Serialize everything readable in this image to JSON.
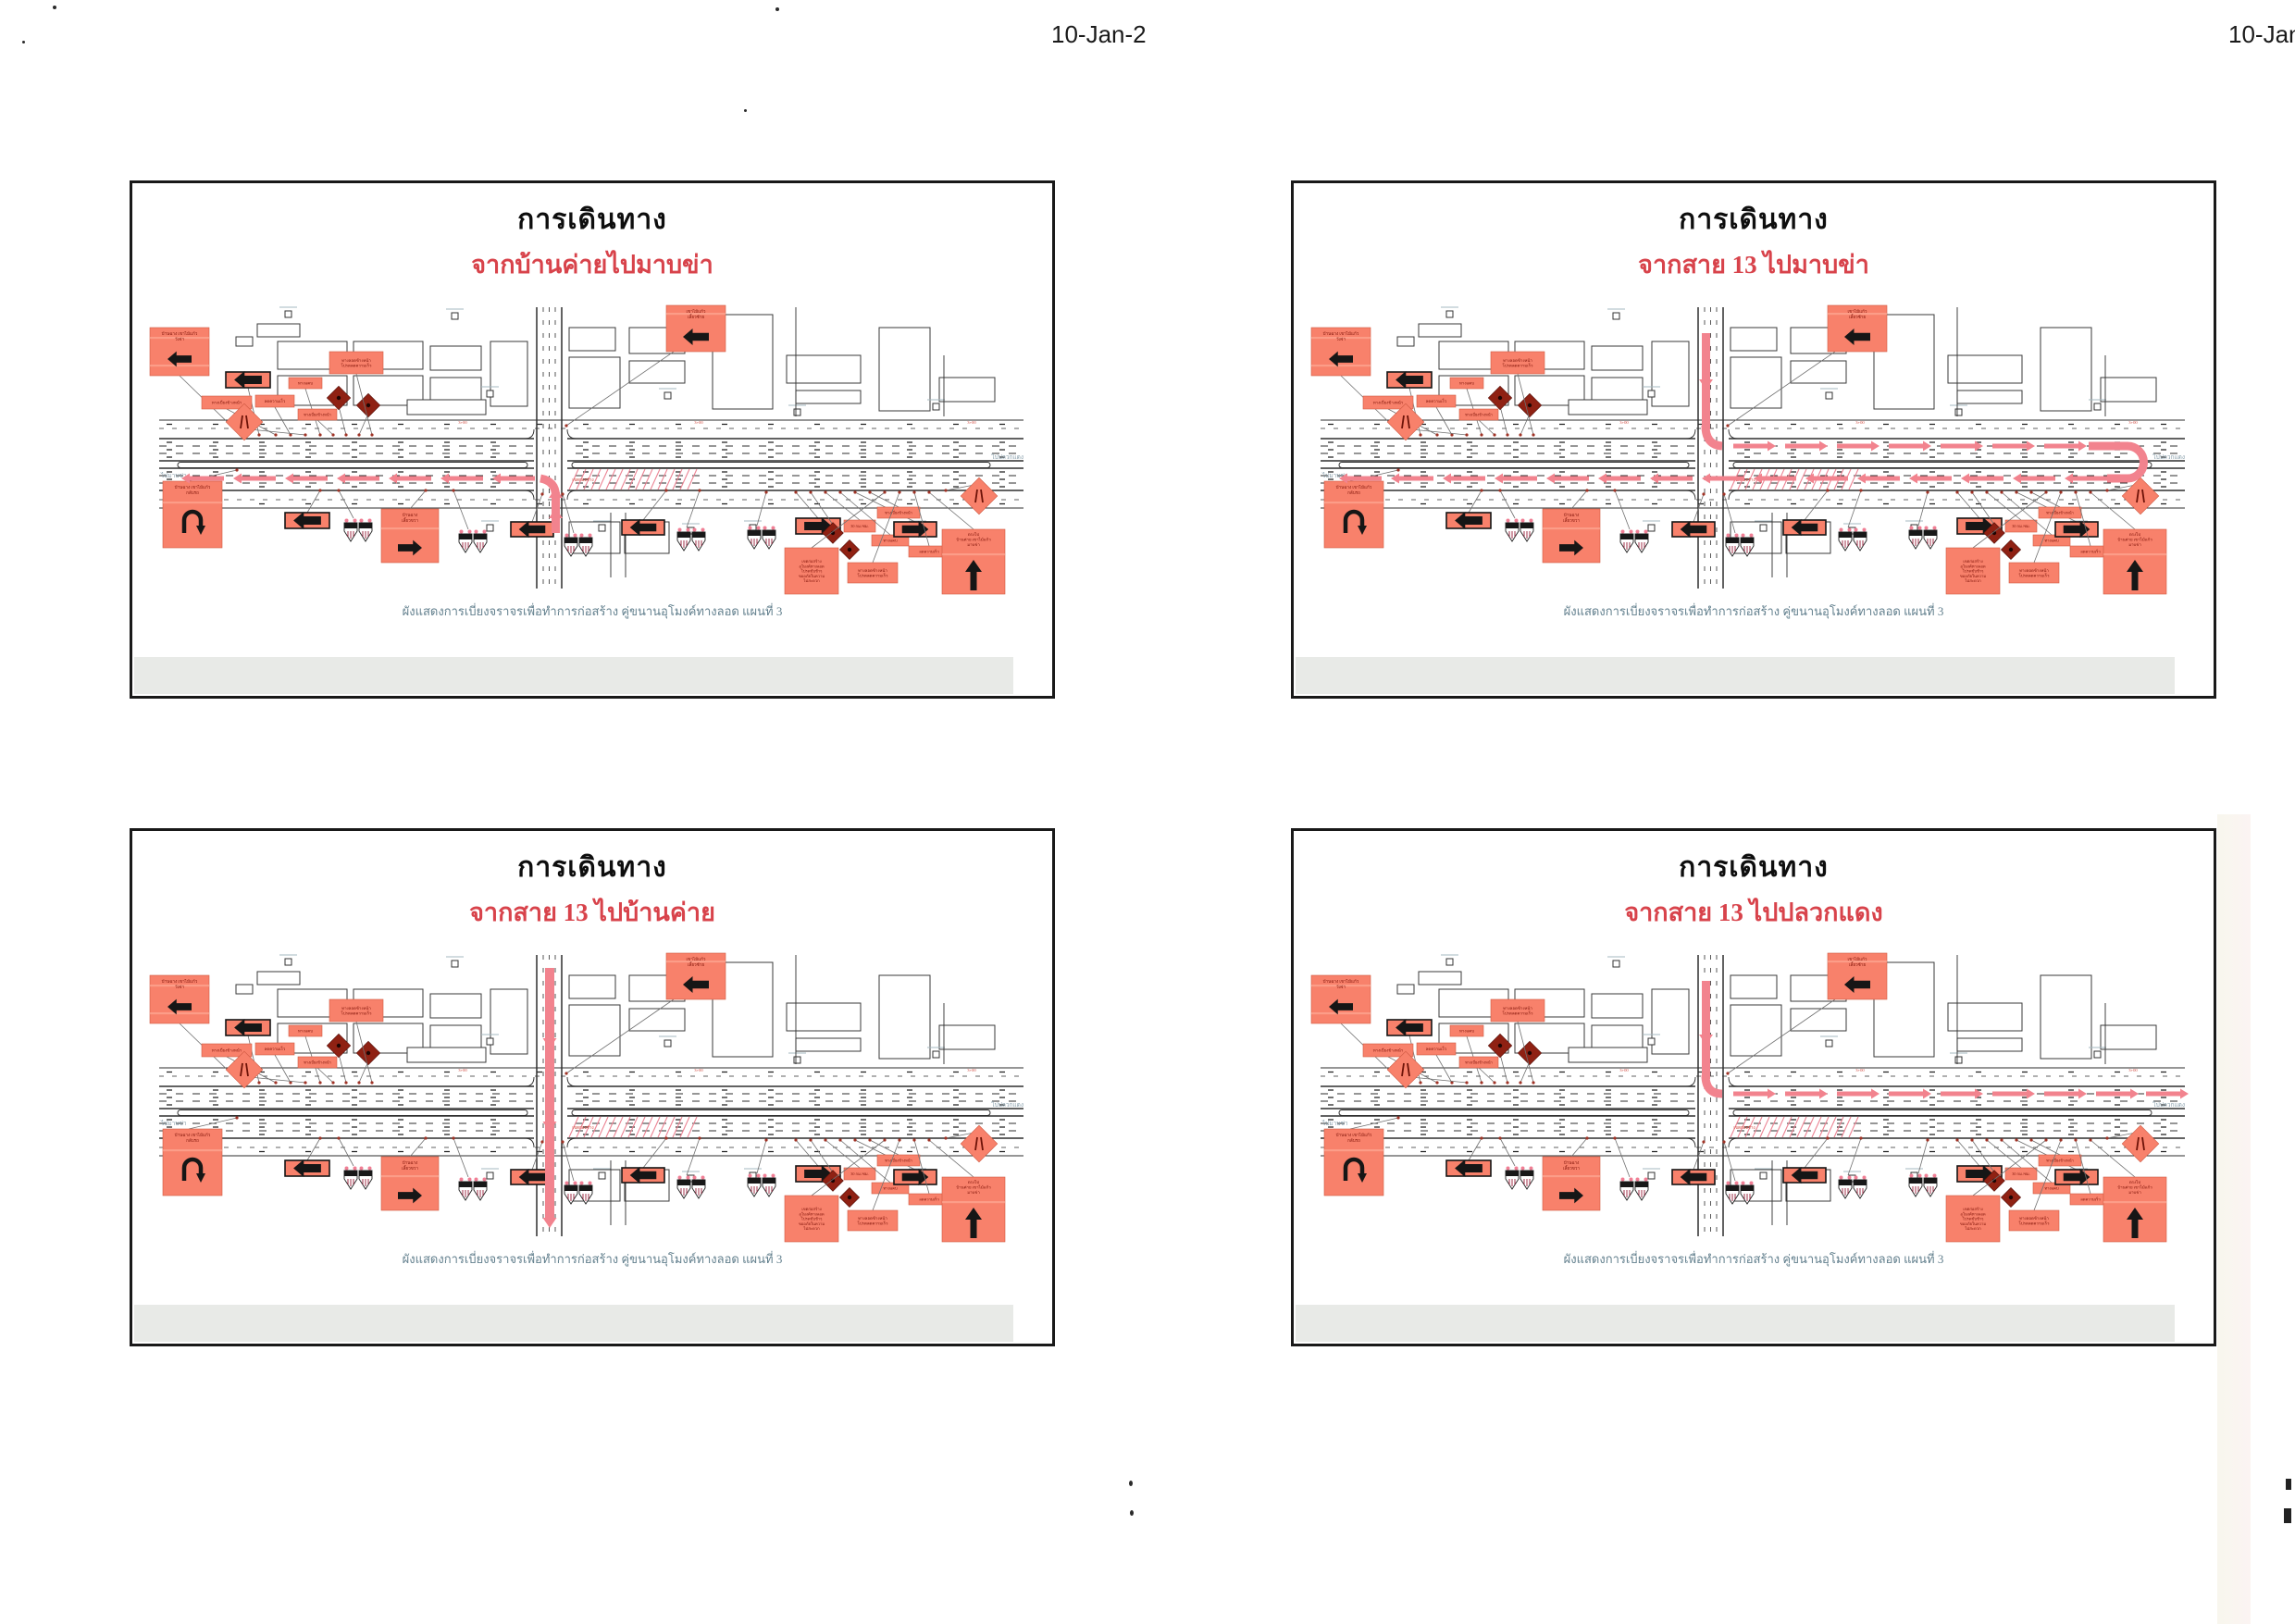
{
  "page": {
    "scan_date_center": "10-Jan-2",
    "scan_date_right": "10-Jan-2"
  },
  "shared": {
    "caption": "ผังแสดงการเบี่ยงจราจรเพื่อทำการก่อสร้าง คู่ขนานอุโมงค์ทางลอด แผนที่ 3"
  },
  "panels": [
    {
      "title": "การเดินทาง",
      "subtitle": "จากบ้านค่ายไปมาบข่า",
      "route": "south-up-turn-west"
    },
    {
      "title": "การเดินทาง",
      "subtitle": "จากสาย 13 ไปมาบข่า",
      "route": "north-down-east-uturn-west"
    },
    {
      "title": "การเดินทาง",
      "subtitle": "จากสาย 13 ไปบ้านค่าย",
      "route": "north-down-straight-south"
    },
    {
      "title": "การเดินทาง",
      "subtitle": "จากสาย 13 ไปปลวกแดง",
      "route": "north-down-turn-east"
    }
  ],
  "map": {
    "road_label_left": "ไปมาบข่า",
    "road_label_right": "ไปปลวกแดง",
    "construction_label": "เขตก่อสร้าง",
    "station_label": "3+00",
    "signs": {
      "detour_left_big": [
        "บ้านฉาง เขาไม้แก้ว",
        "วังจ่า"
      ],
      "left_turn_big": [
        "เขาไม้แก้ว",
        "เลี้ยวซ้าย"
      ],
      "uturn_big": [
        "บ้านฉาง เขาไม้แก้ว",
        "กลับรถ"
      ],
      "right_turn_big": [
        "บ้านฉาง",
        "เลี้ยวขวา"
      ],
      "go_straight_big": [
        "ตรงไป",
        "บ้านค่าย เขาไม้แก้ว",
        "มาบข่า"
      ],
      "construction_zone_tall": [
        "เขตก่อสร้าง",
        "อุโมงค์ทางลอด",
        "โปรดขับช้าๆ",
        "ขออภัยในความ",
        "ไม่สะดวก"
      ],
      "tunnel_project": [
        "ทางลอดข้างหน้า",
        "โปรดลดความเร็ว"
      ],
      "detour_ahead": "ทางเบี่ยงข้างหน้า",
      "reduce_speed": "ลดความเร็ว",
      "narrow_road": "ทางแคบ",
      "speed_30": "30 กม./ชม."
    }
  }
}
